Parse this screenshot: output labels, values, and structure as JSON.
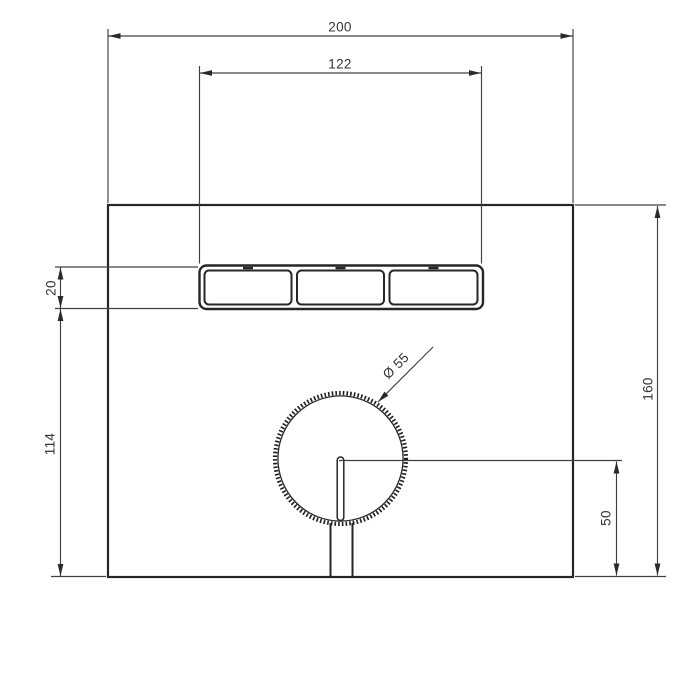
{
  "canvas": {
    "width": 700,
    "height": 700,
    "background": "#ffffff"
  },
  "colors": {
    "geometry_line": "#262626",
    "dimension_line": "#404040",
    "label_text": "#333333"
  },
  "labels": {
    "top_width": "200",
    "button_span": "122",
    "button_height": "20",
    "left_lower_height": "114",
    "plate_height": "160",
    "knob_center_to_bottom": "50",
    "knob_diameter": "Ø 55"
  }
}
